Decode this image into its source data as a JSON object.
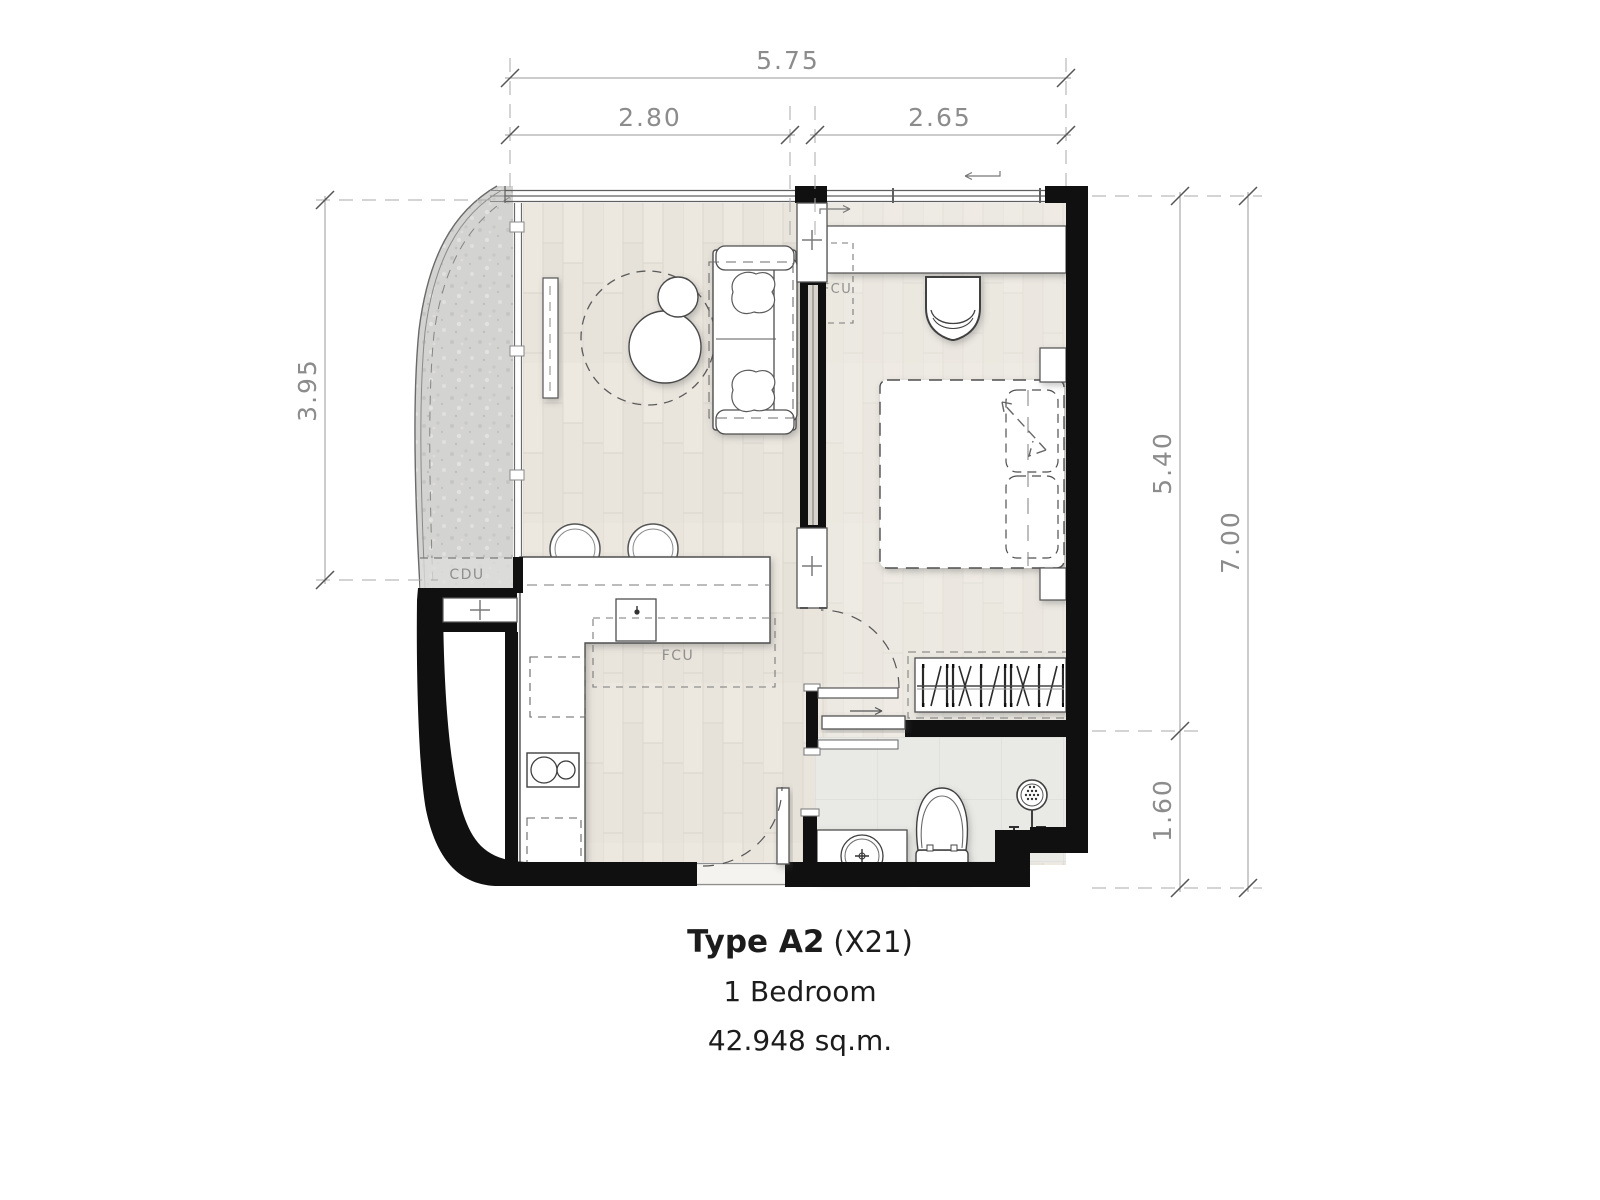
{
  "caption": {
    "title_bold": "Type A2",
    "title_suffix": "(X21)",
    "bedrooms": "1 Bedroom",
    "area": "42.948 sq.m."
  },
  "dimensions": {
    "top_total": "5.75",
    "top_left": "2.80",
    "top_right": "2.65",
    "left_height": "3.95",
    "right_upper": "5.40",
    "right_lower": "1.60",
    "right_total": "7.00"
  },
  "labels": {
    "balcony_unit": "CDU",
    "kitchen_unit": "FCU",
    "bedroom_unit": "FCU"
  },
  "colors": {
    "wall": "#101010",
    "line": "#4a4a4a",
    "dim": "#8c8c8c",
    "title": "#1c1c1c",
    "label": "#8f8f8d",
    "wood": "#eae5dd",
    "tile": "#e9e9e6",
    "balcony": "#d3d3d1"
  }
}
